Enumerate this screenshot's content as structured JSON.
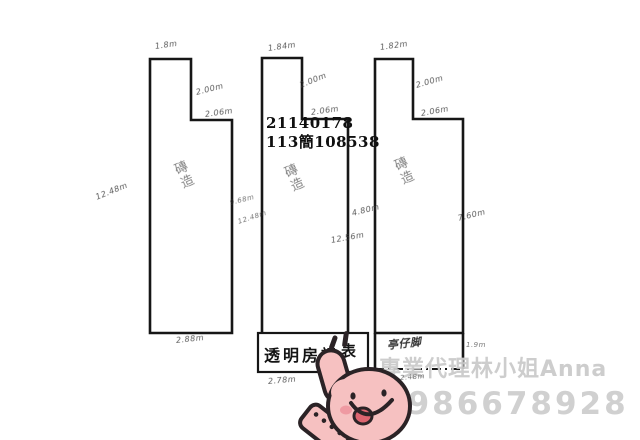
{
  "document": {
    "case_number_line1": "21140178",
    "case_number_line2": "113簡108538",
    "stamp_left": "透明房訊",
    "stamp_right": "表",
    "buildings": {
      "left": {
        "top": "1.8m",
        "side": "2.00m",
        "step": "2.06m",
        "outer_left": "12.48m",
        "inner_right": "9.68m",
        "inner_right2": "12.48m",
        "bottom": "2.88m",
        "interior": "磚造"
      },
      "middle": {
        "top": "1.84m",
        "side": "2.00m",
        "step": "2.06m",
        "bottom": "2.78m",
        "interior": "磚造"
      },
      "right": {
        "top": "1.82m",
        "side": "2.00m",
        "step": "2.06m",
        "gap_left": "4.80m",
        "gap_left2": "12.56m",
        "outer_right": "7.60m",
        "arcade_label": "亭仔脚",
        "arcade_right": "1.9m",
        "arcade_bottom": "2.48m",
        "interior": "磚造"
      }
    },
    "watermark": {
      "agent": "專業代理林小姐Anna",
      "phone": "0986678928"
    },
    "colors": {
      "line": "#161616",
      "sticker_pink": "#f6c1c1",
      "sticker_outline": "#2b2326",
      "watermark_gray": "#cbcbcb"
    }
  }
}
